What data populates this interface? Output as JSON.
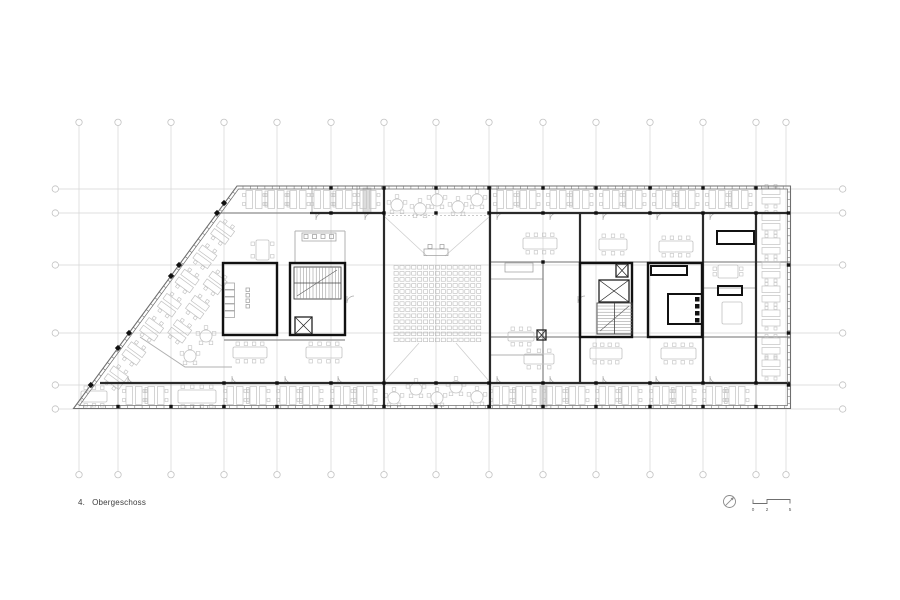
{
  "footer": {
    "floor_number": "4.",
    "floor_name": "Obergeschoss"
  },
  "symbols": {
    "north_arrow": {
      "name": "north-arrow",
      "cx": 729.5,
      "cy": 501.5,
      "r": 6
    },
    "scale_bar": {
      "labels": [
        "0",
        "2",
        "5"
      ],
      "x0": 753,
      "x2": 767,
      "x5": 790,
      "ybase": 503.5,
      "ytop": 499.5,
      "ylabel": 511
    }
  },
  "colors": {
    "grid": "#d4d4d4",
    "grid_circle": "#c2c2c2",
    "furniture": "#c2c2c2",
    "wall_light": "#b0b0b0",
    "wall_medium": "#8c8c8c",
    "wall_dark": "#2a2a2a",
    "core": "#111111",
    "facade": "#6f6f6f",
    "seat": "#b5b5b5",
    "shaft": "#dcdcdc",
    "text": "#3d3d3d"
  },
  "plan": {
    "grid": {
      "vx": [
        79,
        118,
        171,
        224,
        277,
        331,
        384,
        436,
        489,
        543,
        596,
        650,
        703,
        756,
        786
      ],
      "vy_top": 122.3,
      "vy_bot": 474.7,
      "hy": [
        189,
        213,
        265,
        333,
        385,
        409
      ],
      "hx_left": 55.3,
      "hx_right": 842.7,
      "r": 3.2
    },
    "outline": {
      "pts": [
        [
          237,
          186
        ],
        [
          790.5,
          186
        ],
        [
          790.5,
          408.5
        ],
        [
          73.5,
          408.5
        ]
      ],
      "inset": 3,
      "tick_step": 7.3
    },
    "walls": {
      "dark": [
        [
          310,
          213,
          384,
          213
        ],
        [
          490,
          213,
          790,
          213
        ],
        [
          100,
          383,
          790,
          383
        ],
        [
          384,
          186,
          384,
          408
        ],
        [
          490,
          186,
          490,
          408
        ],
        [
          580,
          213,
          580,
          383
        ],
        [
          703,
          213,
          703,
          383
        ],
        [
          756,
          213,
          756,
          383
        ]
      ],
      "medium": [
        [
          218,
          213,
          310,
          213
        ],
        [
          490,
          262,
          790,
          262
        ],
        [
          490,
          337,
          790,
          337
        ],
        [
          543,
          262,
          543,
          383
        ],
        [
          224,
          340,
          345,
          340
        ]
      ],
      "light": [
        [
          312,
          186,
          312,
          213
        ],
        [
          357,
          186,
          357,
          213
        ],
        [
          497,
          186,
          497,
          213
        ],
        [
          543,
          186,
          543,
          213
        ],
        [
          596,
          186,
          596,
          213
        ],
        [
          650,
          186,
          650,
          213
        ],
        [
          703,
          186,
          703,
          213
        ],
        [
          118,
          383,
          118,
          408
        ],
        [
          171,
          383,
          171,
          408
        ],
        [
          224,
          383,
          224,
          408
        ],
        [
          277,
          383,
          277,
          408
        ],
        [
          331,
          383,
          331,
          408
        ],
        [
          490,
          383,
          490,
          408
        ],
        [
          543,
          383,
          543,
          408
        ],
        [
          596,
          383,
          596,
          408
        ],
        [
          650,
          383,
          650,
          408
        ],
        [
          703,
          383,
          703,
          408
        ],
        [
          756,
          383,
          756,
          408
        ],
        [
          756,
          186,
          756,
          213
        ],
        [
          756,
          333,
          790,
          333
        ],
        [
          703,
          288,
          756,
          288
        ],
        [
          295,
          231,
          345,
          231
        ],
        [
          295,
          231,
          295,
          263
        ],
        [
          345,
          231,
          345,
          263
        ],
        [
          490,
          279,
          543,
          279
        ],
        [
          490,
          355,
          543,
          355
        ]
      ],
      "railing": [
        [
          140,
          337
        ],
        [
          185,
          367
        ],
        [
          232,
          367
        ]
      ]
    },
    "cores": [
      [
        223,
        263,
        54,
        72
      ],
      [
        290,
        263,
        55,
        72
      ],
      [
        580,
        263,
        52,
        74
      ],
      [
        648,
        263,
        54,
        74
      ]
    ],
    "stairs": [
      {
        "x": 294,
        "y": 267,
        "w": 47,
        "h": 32,
        "dir": "h"
      },
      {
        "x": 597,
        "y": 303,
        "w": 35,
        "h": 31,
        "dir": "v"
      }
    ],
    "elevators": [
      [
        295,
        317,
        17,
        17
      ],
      [
        599,
        280,
        30,
        22
      ],
      [
        616,
        264,
        12,
        13
      ],
      [
        537,
        330,
        9,
        10
      ]
    ],
    "shafts": [
      [
        363,
        188,
        8,
        25
      ],
      [
        540,
        386,
        7,
        21
      ]
    ],
    "fixtures": {
      "rects_dark": [
        [
          651,
          266,
          36,
          9
        ],
        [
          668,
          294,
          34,
          30
        ],
        [
          717,
          231,
          37,
          13
        ],
        [
          718,
          286,
          24,
          9
        ]
      ],
      "rects_light": [
        [
          224.5,
          283,
          10,
          6.5
        ],
        [
          224.5,
          290,
          10,
          6.5
        ],
        [
          224.5,
          297,
          10,
          6.5
        ],
        [
          224.5,
          304,
          10,
          6.5
        ],
        [
          224.5,
          311,
          10,
          6.5
        ],
        [
          246,
          288,
          3.5,
          3.5
        ],
        [
          246,
          293.5,
          3.5,
          3.5
        ],
        [
          246,
          299,
          3.5,
          3.5
        ],
        [
          246,
          304.5,
          3.5,
          3.5
        ],
        [
          302,
          233,
          34,
          8
        ],
        [
          304,
          234.5,
          4,
          4
        ],
        [
          312.5,
          234.5,
          4,
          4
        ],
        [
          321,
          234.5,
          4,
          4
        ],
        [
          329.5,
          234.5,
          4,
          4
        ],
        [
          424,
          249,
          24,
          6.5
        ],
        [
          428,
          244.5,
          4,
          4
        ],
        [
          440,
          244.5,
          4,
          4
        ],
        [
          505,
          263,
          28,
          9
        ]
      ],
      "squares_black": [
        [
          695,
          297,
          4.5
        ],
        [
          695,
          304,
          4.5
        ],
        [
          695,
          311,
          4.5
        ],
        [
          695,
          318,
          4.5
        ]
      ]
    },
    "seating": {
      "x": 394,
      "y": 265.5,
      "rows": 13,
      "cols": 15,
      "px": 5.9,
      "py": 6.05,
      "w": 4.2,
      "h": 3.6
    },
    "desks": {
      "top_y": 199.5,
      "top_xs": [
        254,
        276,
        298,
        322,
        344,
        368,
        505,
        528,
        558,
        581,
        611,
        634,
        664,
        687,
        717,
        740
      ],
      "bottom_y": 395.5,
      "bottom_xs": [
        134,
        156,
        235,
        258,
        288,
        311,
        342,
        365,
        501,
        524,
        554,
        577,
        607,
        630,
        661,
        684,
        714,
        737
      ],
      "right_x": 771,
      "right_ys": [
        196,
        222,
        246,
        270,
        294,
        318,
        346,
        368
      ],
      "diag_angle": -53.7,
      "diag_pts": [
        [
          116.1,
          377.7
        ],
        [
          133.9,
          353.5
        ],
        [
          151.6,
          329.3
        ],
        [
          169.4,
          305.2
        ],
        [
          187.1,
          281.0
        ],
        [
          204.9,
          256.8
        ],
        [
          222.6,
          232.6
        ],
        [
          179.7,
          331.4
        ],
        [
          197.5,
          307.2
        ],
        [
          215.2,
          283.0
        ]
      ],
      "cab_top_y": 191,
      "cab_top_xs": [
        265,
        287,
        333,
        516.5,
        569.5,
        622.5,
        675.5,
        728.5
      ],
      "cab_bot_y": 387.5,
      "cab_bot_xs": [
        145,
        246.5,
        299.5,
        353.5,
        512.5,
        565.5,
        618.5,
        671.5,
        724.5
      ]
    },
    "tables": [
      [
        233,
        347,
        34,
        11,
        "tb"
      ],
      [
        306,
        347,
        36,
        11,
        "tb"
      ],
      [
        523,
        238,
        34,
        11,
        "tb"
      ],
      [
        599,
        239,
        28,
        11,
        "tb"
      ],
      [
        659,
        241,
        34,
        11,
        "tb"
      ],
      [
        590,
        348,
        32,
        11,
        "tb"
      ],
      [
        661,
        348,
        35,
        11,
        "tb"
      ],
      [
        178,
        390,
        38,
        13,
        "tb"
      ],
      [
        81,
        391,
        26,
        11,
        "tb"
      ],
      [
        508,
        332,
        26,
        9,
        "tb"
      ],
      [
        524,
        354,
        30,
        10,
        "tb"
      ],
      [
        718,
        265,
        20,
        13,
        "lr"
      ],
      [
        722,
        302,
        20,
        22,
        "none"
      ],
      [
        256,
        240,
        13,
        20,
        "lr"
      ]
    ],
    "round_tables": [
      [
        397,
        205
      ],
      [
        420,
        209
      ],
      [
        437,
        200
      ],
      [
        458,
        207
      ],
      [
        477,
        200
      ],
      [
        394,
        398
      ],
      [
        416,
        389
      ],
      [
        437,
        398
      ],
      [
        456,
        387
      ],
      [
        477,
        397
      ],
      [
        206,
        336
      ],
      [
        190,
        356
      ]
    ],
    "door_arcs": [
      [
        316,
        213,
        "d"
      ],
      [
        365,
        213,
        "d"
      ],
      [
        497,
        213,
        "d"
      ],
      [
        550,
        213,
        "d"
      ],
      [
        603,
        213,
        "d"
      ],
      [
        657,
        213,
        "d"
      ],
      [
        710,
        213,
        "d"
      ],
      [
        128,
        383,
        "u"
      ],
      [
        232,
        383,
        "u"
      ],
      [
        285,
        383,
        "u"
      ],
      [
        338,
        383,
        "u"
      ],
      [
        497,
        383,
        "u"
      ],
      [
        550,
        383,
        "u"
      ],
      [
        603,
        383,
        "u"
      ],
      [
        656,
        383,
        "u"
      ],
      [
        710,
        383,
        "u"
      ],
      [
        347,
        296,
        "d"
      ],
      [
        578,
        296,
        "d"
      ]
    ],
    "sight_lines": [
      [
        385,
        217,
        427,
        256
      ],
      [
        489,
        217,
        445,
        256
      ],
      [
        385,
        381,
        419,
        343
      ],
      [
        489,
        381,
        456,
        343
      ]
    ],
    "dashed_lines": [
      [
        384,
        215.5,
        490,
        215.5
      ]
    ],
    "columns": {
      "size": 3.4,
      "pts": [
        [
          331,
          188
        ],
        [
          384,
          188
        ],
        [
          436,
          188
        ],
        [
          489,
          188
        ],
        [
          543,
          188
        ],
        [
          596,
          188
        ],
        [
          650,
          188
        ],
        [
          703,
          188
        ],
        [
          756,
          188
        ],
        [
          331,
          213
        ],
        [
          384,
          213
        ],
        [
          436,
          213
        ],
        [
          489,
          213
        ],
        [
          543,
          213
        ],
        [
          596,
          213
        ],
        [
          650,
          213
        ],
        [
          703,
          213
        ],
        [
          756,
          213
        ],
        [
          118,
          406.5
        ],
        [
          171,
          406.5
        ],
        [
          224,
          406.5
        ],
        [
          277,
          406.5
        ],
        [
          331,
          406.5
        ],
        [
          384,
          406.5
        ],
        [
          436,
          406.5
        ],
        [
          489,
          406.5
        ],
        [
          543,
          406.5
        ],
        [
          596,
          406.5
        ],
        [
          650,
          406.5
        ],
        [
          703,
          406.5
        ],
        [
          756,
          406.5
        ],
        [
          224,
          383
        ],
        [
          277,
          383
        ],
        [
          331,
          383
        ],
        [
          384,
          383
        ],
        [
          436,
          383
        ],
        [
          489,
          383
        ],
        [
          543,
          383
        ],
        [
          596,
          383
        ],
        [
          650,
          383
        ],
        [
          703,
          383
        ],
        [
          756,
          383
        ],
        [
          788.5,
          213
        ],
        [
          788.5,
          265
        ],
        [
          788.5,
          333
        ],
        [
          788.5,
          385
        ],
        [
          543,
          262
        ]
      ]
    },
    "diamonds": [
      [
        217,
        213
      ],
      [
        179,
        265
      ],
      [
        129,
        333
      ],
      [
        90.8,
        385
      ],
      [
        118,
        348
      ],
      [
        171,
        276
      ],
      [
        224,
        203
      ]
    ]
  }
}
